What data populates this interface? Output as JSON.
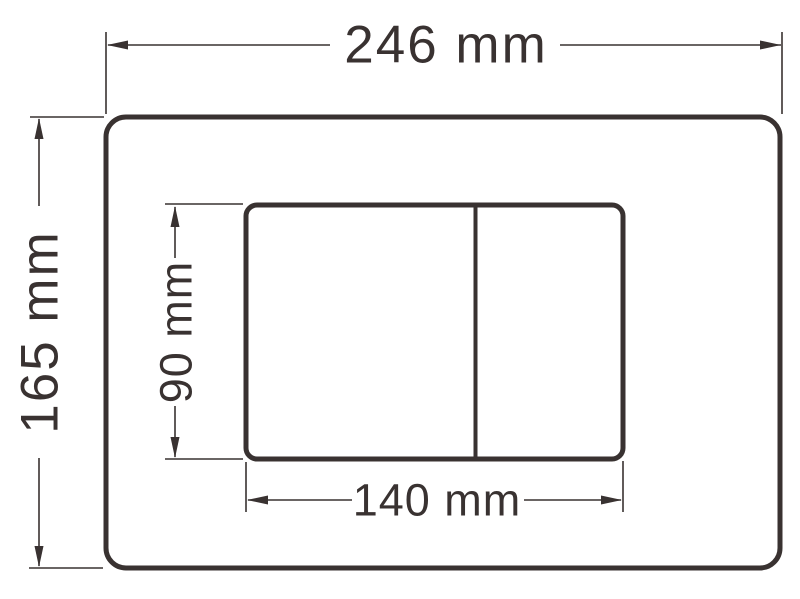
{
  "drawing": {
    "subject": "dual-flush-plate-dimension-drawing",
    "colors": {
      "line": "#393231",
      "background": "#ffffff"
    },
    "dimensions": {
      "plate_width": {
        "label": "246 mm"
      },
      "plate_height": {
        "label": "165 mm"
      },
      "buttons_width": {
        "label": "140 mm"
      },
      "buttons_height": {
        "label": "90 mm"
      }
    }
  }
}
